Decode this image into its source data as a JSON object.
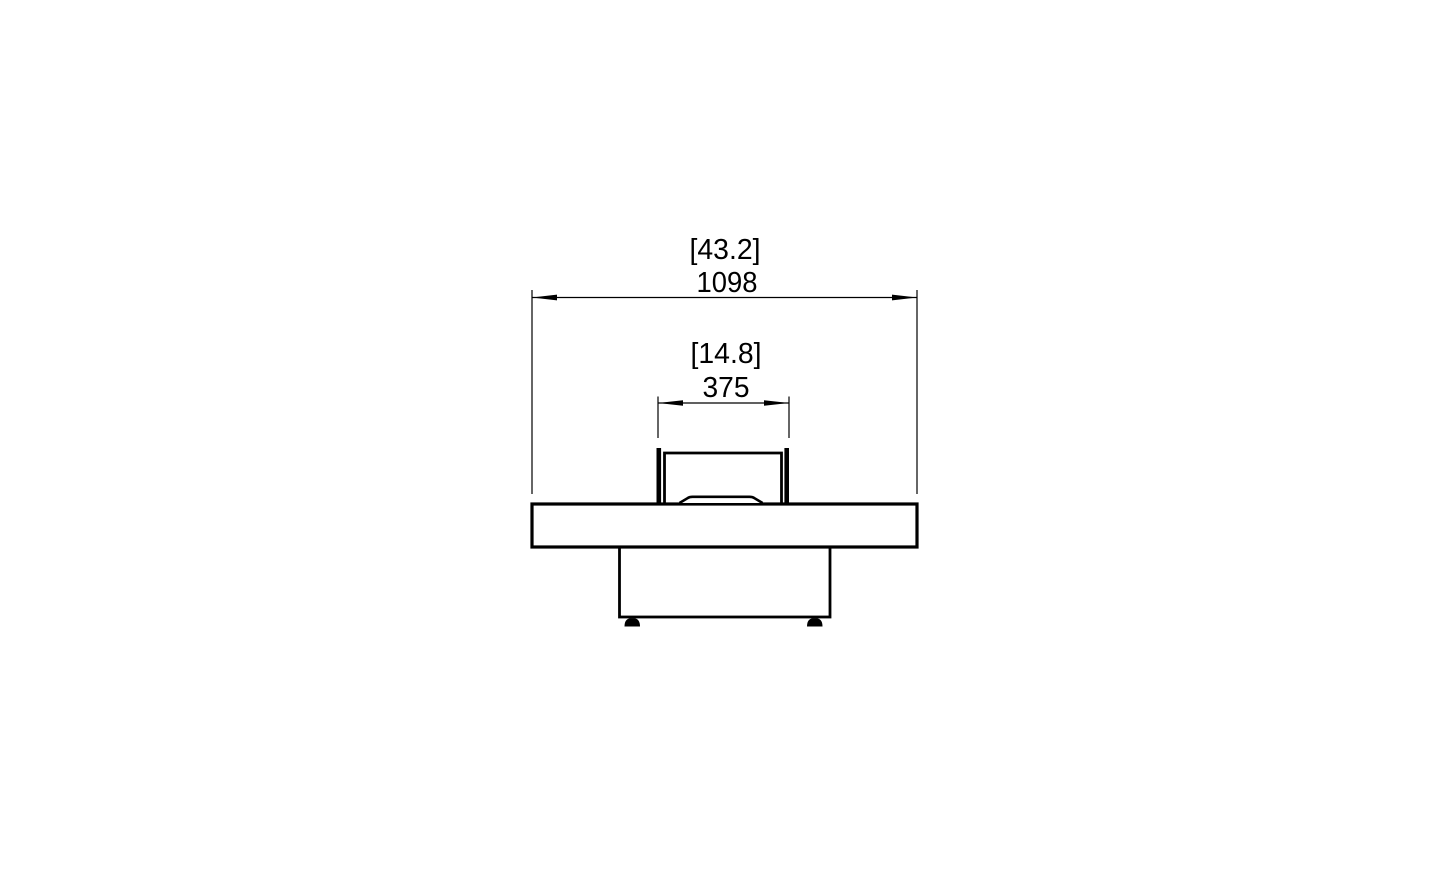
{
  "document": {
    "type": "technical-drawing",
    "view": "fire-pit-table-front-elevation",
    "background_color": "#ffffff",
    "line_color": "#000000"
  },
  "dimensions": {
    "overall_width": {
      "imperial": "[43.2]",
      "metric": "1098"
    },
    "burner_opening_width": {
      "imperial": "[14.8]",
      "metric": "375"
    }
  }
}
